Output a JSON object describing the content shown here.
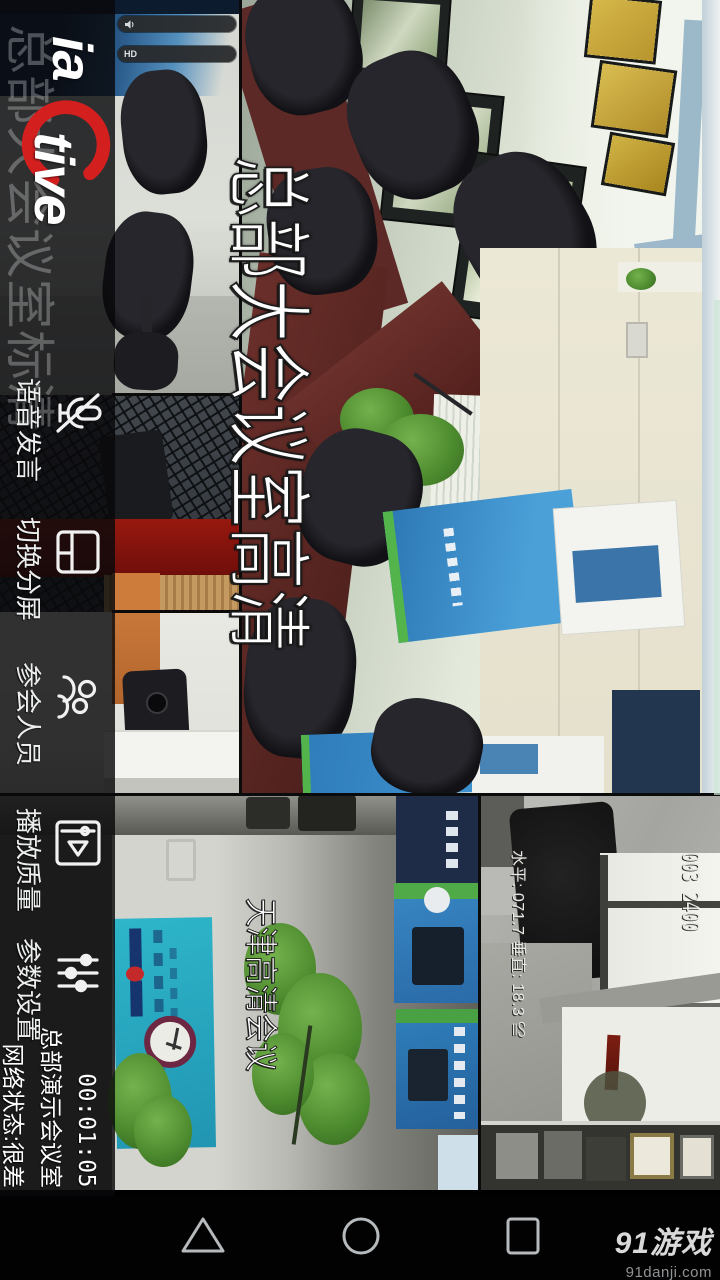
{
  "app": {
    "logo": {
      "text_left": "ia",
      "text_right": "tive",
      "swoosh_color": "#d41f1f"
    },
    "toolbar": {
      "ghost_video_label": "总部大会议室标清",
      "buttons": [
        {
          "icon": "mic-muted-icon",
          "label": "语音发言"
        },
        {
          "icon": "split-screen-icon",
          "label": "切换分屏"
        },
        {
          "icon": "participants-icon",
          "label": "参会人员"
        },
        {
          "icon": "play-quality-icon",
          "label": "播放质量"
        },
        {
          "icon": "settings-sliders-icon",
          "label": "参数设置"
        }
      ],
      "status": {
        "timer": "00:01:05",
        "room_name": "总部演示会议室",
        "network": "网络状态:很差"
      }
    },
    "videos": {
      "main": {
        "label": "总部大会议室高清"
      },
      "tianjin": {
        "label": "天津高清会议"
      },
      "ptz_camera": {
        "osd_top": "003 2400",
        "osd_bottom": "水平: 071.7 垂直: 18.3 ≌"
      }
    },
    "toasts": [
      {
        "icon": "speaker-icon",
        "badge": ""
      },
      {
        "icon": "hd-badge-icon",
        "badge": "HD"
      }
    ]
  },
  "android_nav": {
    "back_icon": "triangle",
    "home_icon": "circle",
    "recents_icon": "square"
  },
  "watermark": {
    "brand": "91游戏",
    "site": "91danji.com"
  },
  "colors": {
    "toolbar_bg": "rgba(8,9,11,0.82)",
    "accent_red": "#d41f1f",
    "toast_bg": "#2a2c2e",
    "nav_icon": "#b6babc",
    "osd_text": "#e9e9e4",
    "poster_cyan": "#2eb6ca",
    "banner_blue": "#2b76b4"
  }
}
